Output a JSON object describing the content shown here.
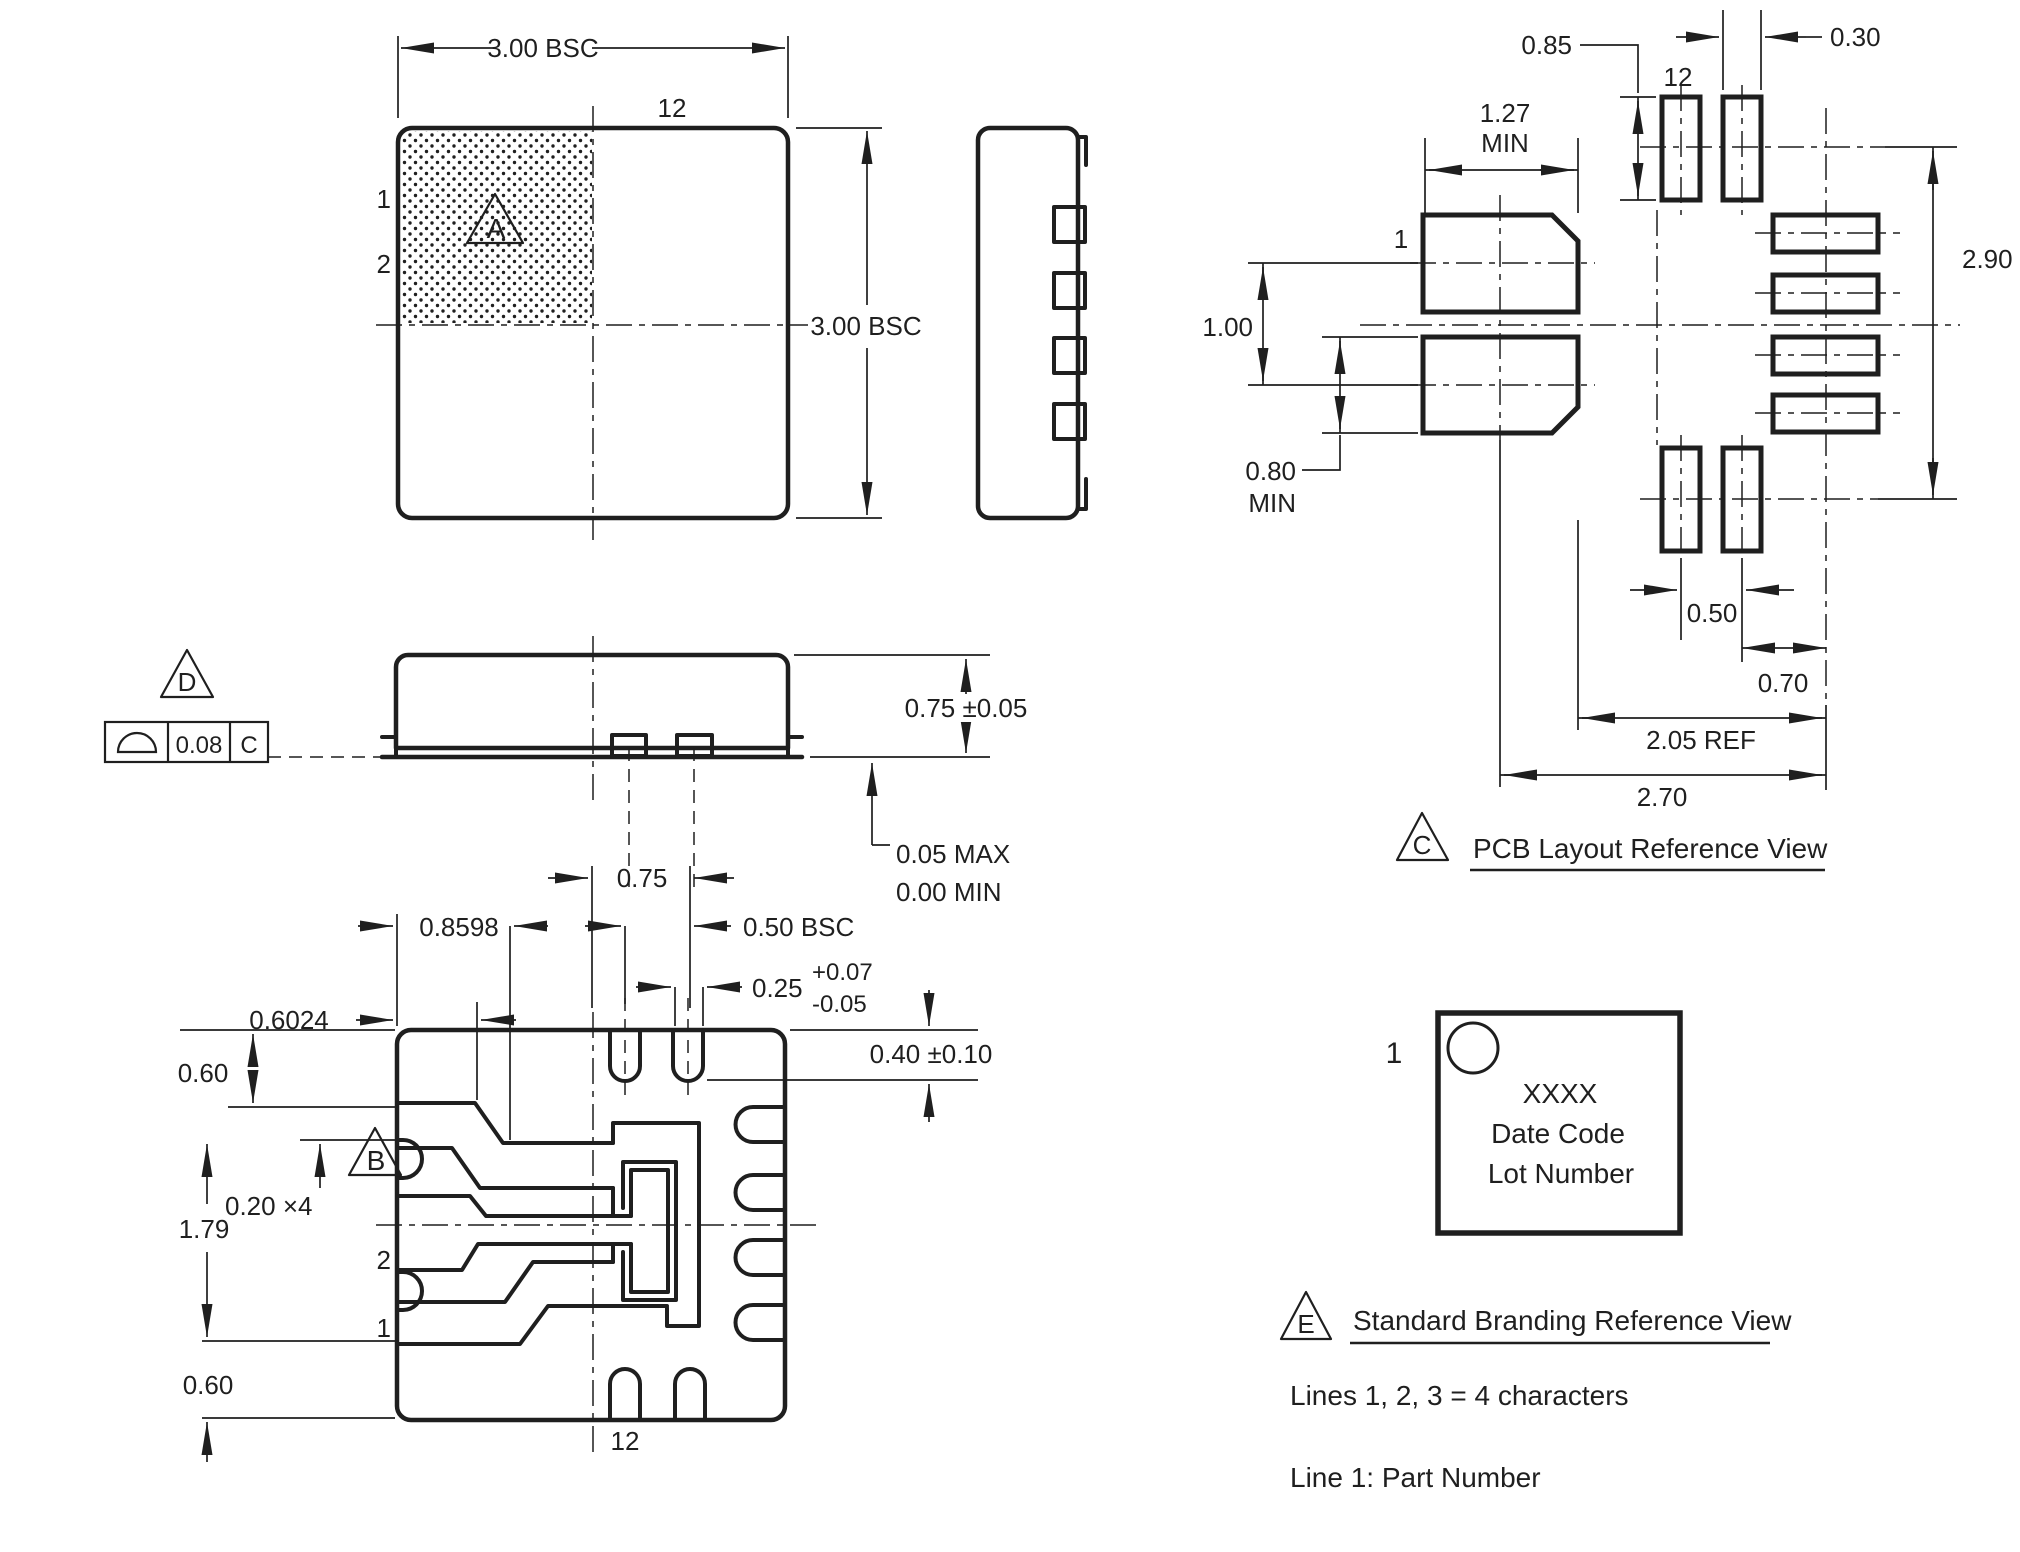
{
  "drawing": {
    "ink_color": "#1f1f1f",
    "background_color": "#ffffff",
    "top_view": {
      "flag": "A",
      "dim_width": "3.00 BSC",
      "dim_height": "3.00 BSC",
      "pin1": "1",
      "pin2": "2",
      "pin12": "12"
    },
    "front_view": {
      "flag": "D",
      "fcf_symbol": "surface-profile-icon",
      "fcf_tolerance": "0.08",
      "fcf_datum": "C",
      "dim_body_height": "0.75 ±0.05",
      "dim_standoff_max": "0.05 MAX",
      "dim_standoff_min": "0.00 MIN"
    },
    "bottom_view": {
      "flag": "B",
      "pin1": "1",
      "pin2": "2",
      "pin12": "12",
      "dim_pad_pitch": "0.75",
      "dim_lead_offset": "0.8598",
      "dim_pitch": "0.50 BSC",
      "dim_edge_offset": "0.6024",
      "dim_slot_width": "0.25",
      "dim_slot_width_tol_plus": "+0.07",
      "dim_slot_width_tol_minus": "-0.05",
      "dim_slot_depth": "0.40 ±0.10",
      "dim_top_clear": "0.60",
      "dim_jog": "0.20 ×4",
      "dim_lead_span": "1.79",
      "dim_bottom_clear": "0.60"
    },
    "pcb_view": {
      "flag": "C",
      "title": "PCB Layout Reference View",
      "pin1": "1",
      "pin12": "12",
      "dim_pad_len": "0.85",
      "dim_pad_width": "0.30",
      "dim_big_pad_len": "1.27",
      "dim_big_pad_len_qual": "MIN",
      "dim_big_pad_pitch": "1.00",
      "dim_big_pad_width": "0.80",
      "dim_big_pad_width_qual": "MIN",
      "dim_span_v": "2.90",
      "dim_pitch": "0.50",
      "dim_center_offset": "0.70",
      "dim_ref": "2.05 REF",
      "dim_span_h": "2.70"
    },
    "branding_view": {
      "flag": "E",
      "title": "Standard Branding Reference View",
      "pin1": "1",
      "mark_line1": "XXXX",
      "mark_line2": "Date Code",
      "mark_line3": "Lot Number",
      "note1": "Lines 1, 2, 3 = 4 characters",
      "note2": "Line 1: Part Number"
    }
  }
}
